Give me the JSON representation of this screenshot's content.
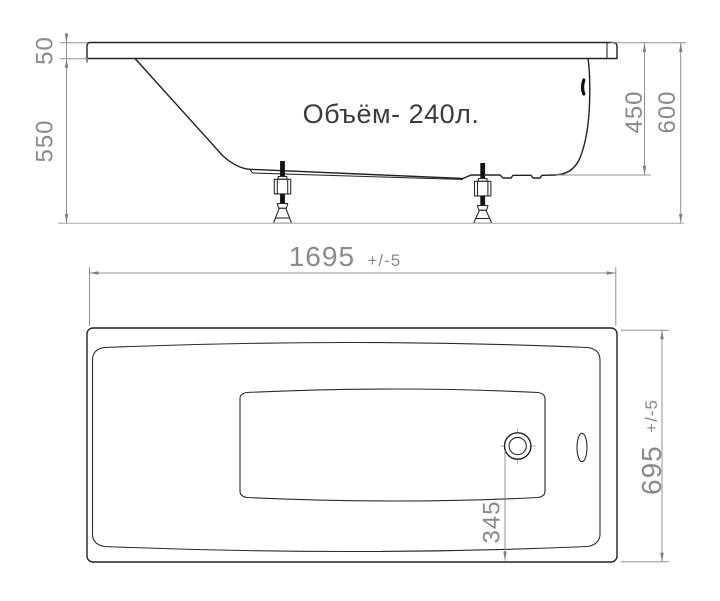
{
  "drawing_title": "Bathtub technical drawing, side view and plan view",
  "side_view": {
    "volume_label": "Объём- 240л.",
    "dims": {
      "rim_thickness": "50",
      "body_height": "550",
      "inner_depth": "450",
      "total_height": "600"
    }
  },
  "plan_view": {
    "dims": {
      "length": "1695",
      "length_tol": "+/-5",
      "width": "695",
      "width_tol": "+/-5",
      "drain_offset": "345"
    }
  },
  "colors": {
    "outline": "#222222",
    "dimension": "#8a8a8a",
    "label_text": "#3c3c3c",
    "ground": "#bdbdbd"
  }
}
